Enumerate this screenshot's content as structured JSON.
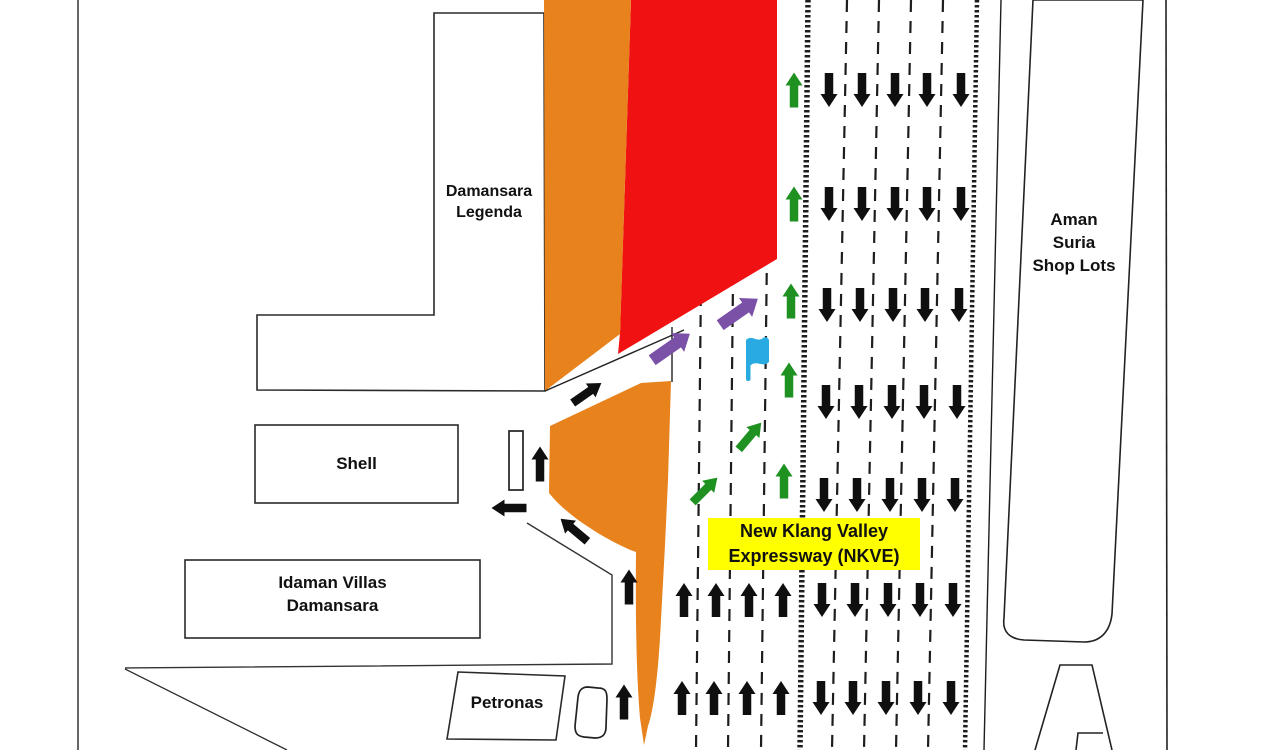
{
  "labels": {
    "damansara_legenda": {
      "line1": "Damansara",
      "line2": "Legenda"
    },
    "shell": {
      "text": "Shell"
    },
    "idaman_villas": {
      "line1": "Idaman Villas",
      "line2": "Damansara"
    },
    "petronas": {
      "text": "Petronas"
    },
    "aman_suria": {
      "line1": "Aman",
      "line2": "Suria",
      "line3": "Shop Lots"
    },
    "nkve": {
      "line1": "New Klang Valley",
      "line2": "Expressway (NKVE)"
    }
  },
  "colors": {
    "orange": "#E8821C",
    "red": "#F01212",
    "green": "#1E9121",
    "purple": "#7B51A8",
    "blue": "#29ABE2",
    "yellow": "#FFFF00",
    "black": "#0F0F0F",
    "line": "#222222"
  },
  "icons": {
    "flag": "location-flag-icon",
    "down_arrow": "down-arrow-icon",
    "up_arrow": "up-arrow-icon",
    "merge_arrow": "merge-arrow-icon"
  },
  "arrows": {
    "groups": [
      {
        "name": "southbound-down-arrow",
        "color": "black",
        "angle": 180,
        "len": 34,
        "headW": 17,
        "headL": 13,
        "shaftW": 8.5,
        "points": [
          [
            829,
            90
          ],
          [
            862,
            90
          ],
          [
            895,
            90
          ],
          [
            927,
            90
          ],
          [
            961,
            90
          ],
          [
            829,
            204
          ],
          [
            862,
            204
          ],
          [
            895,
            204
          ],
          [
            927,
            204
          ],
          [
            961,
            204
          ],
          [
            827,
            305
          ],
          [
            860,
            305
          ],
          [
            893,
            305
          ],
          [
            925,
            305
          ],
          [
            959,
            305
          ],
          [
            826,
            402
          ],
          [
            859,
            402
          ],
          [
            892,
            402
          ],
          [
            924,
            402
          ],
          [
            957,
            402
          ],
          [
            824,
            495
          ],
          [
            857,
            495
          ],
          [
            890,
            495
          ],
          [
            922,
            495
          ],
          [
            955,
            495
          ],
          [
            822,
            600
          ],
          [
            855,
            600
          ],
          [
            888,
            600
          ],
          [
            920,
            600
          ],
          [
            953,
            600
          ],
          [
            821,
            698
          ],
          [
            853,
            698
          ],
          [
            886,
            698
          ],
          [
            918,
            698
          ],
          [
            951,
            698
          ]
        ]
      },
      {
        "name": "northbound-up-arrow",
        "color": "black",
        "angle": 0,
        "len": 34,
        "headW": 17,
        "headL": 13,
        "shaftW": 8.5,
        "points": [
          [
            684,
            600
          ],
          [
            716,
            600
          ],
          [
            749,
            600
          ],
          [
            783,
            600
          ],
          [
            682,
            698
          ],
          [
            714,
            698
          ],
          [
            747,
            698
          ],
          [
            781,
            698
          ]
        ]
      },
      {
        "name": "ramp-black-arrow",
        "color": "black",
        "angle": 0,
        "len": 35,
        "headW": 17,
        "headL": 13,
        "shaftW": 8.5,
        "points": [
          [
            540,
            464,
            0
          ],
          [
            629,
            587,
            0
          ],
          [
            624,
            702,
            0
          ],
          [
            509,
            508,
            -90
          ],
          [
            574,
            530,
            -50
          ],
          [
            587,
            393,
            55
          ]
        ]
      },
      {
        "name": "northbound-green-arrow",
        "color": "green",
        "angle": 0,
        "len": 35,
        "headW": 17,
        "headL": 13,
        "shaftW": 8.5,
        "points": [
          [
            794,
            90
          ],
          [
            794,
            204
          ],
          [
            791,
            301
          ],
          [
            789,
            380
          ],
          [
            784,
            481
          ],
          [
            750,
            436,
            40
          ],
          [
            705,
            490,
            45
          ]
        ]
      },
      {
        "name": "merge-purple-arrow",
        "color": "purple",
        "angle": 55,
        "len": 46,
        "headW": 23,
        "headL": 15,
        "shaftW": 12,
        "points": [
          [
            671,
            347
          ],
          [
            739,
            312
          ]
        ]
      }
    ]
  }
}
